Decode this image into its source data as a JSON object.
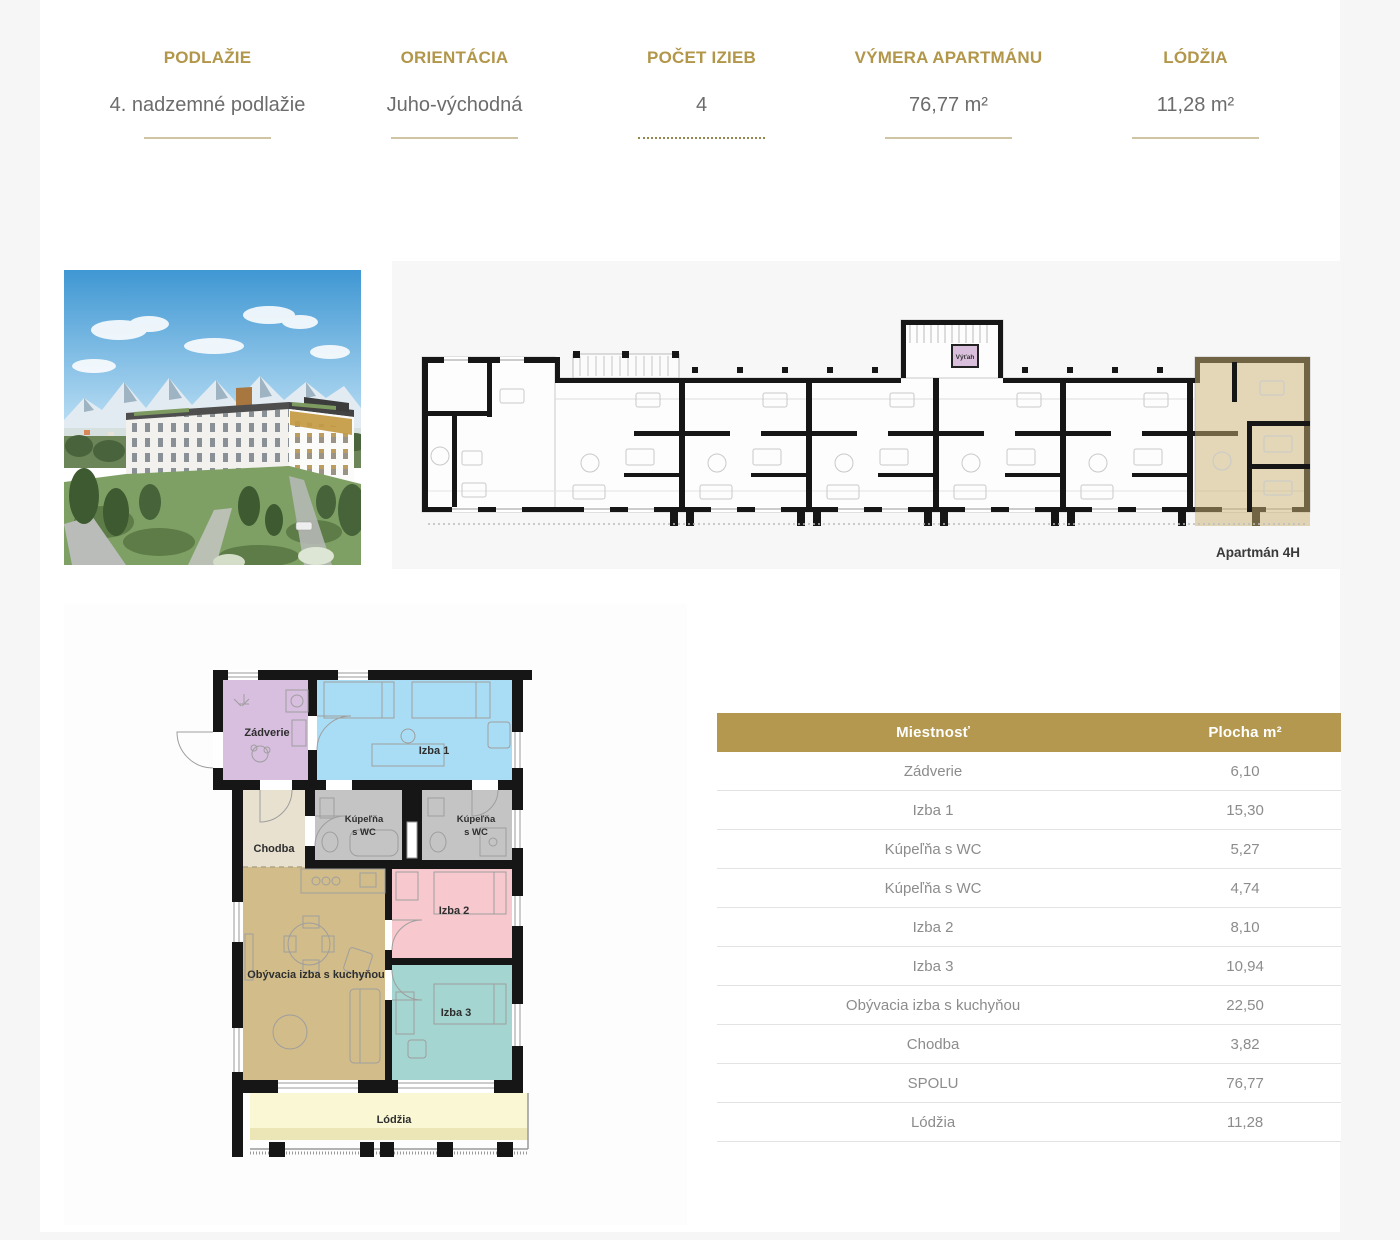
{
  "summary": {
    "items": [
      {
        "label": "PODLAŽIE",
        "value": "4. nadzemné podlažie"
      },
      {
        "label": "ORIENTÁCIA",
        "value": "Juho-východná"
      },
      {
        "label": "POČET IZIEB",
        "value": "4"
      },
      {
        "label": "VÝMERA APARTMÁNU",
        "value": "76,77 m²"
      },
      {
        "label": "LÓDŽIA",
        "value": "11,28 m²"
      }
    ]
  },
  "overview_plan": {
    "apartment_label": "Apartmán 4H",
    "elevator_label": "Výťah",
    "highlight_color": "#c9b173"
  },
  "detail_plan": {
    "rooms": {
      "zadverie": "Zádverie",
      "izba1": "Izba 1",
      "chodba": "Chodba",
      "kupelna_line1": "Kúpeľňa",
      "kupelna_line2": "s WC",
      "obyvacia": "Obývacia izba s kuchyňou",
      "izba2": "Izba 2",
      "izba3": "Izba 3",
      "lodzia": "Lódžia"
    },
    "room_colors": {
      "zadverie": "#d8bfdf",
      "izba1": "#a9ddf5",
      "chodba": "#e8e1d0",
      "kupelna": "#c4c4c4",
      "obyvacia": "#d2bd8a",
      "izba2": "#f7c9cf",
      "izba3": "#a5d5d0",
      "lodzia": "#faf7d4",
      "elevator": "#d9bfdb"
    },
    "accent_gold": "#b5984f"
  },
  "table": {
    "header": [
      "Miestnosť",
      "Plocha m²"
    ],
    "rows": [
      [
        "Zádverie",
        "6,10"
      ],
      [
        "Izba 1",
        "15,30"
      ],
      [
        "Kúpeľňa s WC",
        "5,27"
      ],
      [
        "Kúpeľňa s WC",
        "4,74"
      ],
      [
        "Izba 2",
        "8,10"
      ],
      [
        "Izba 3",
        "10,94"
      ],
      [
        "Obývacia izba s kuchyňou",
        "22,50"
      ],
      [
        "Chodba",
        "3,82"
      ],
      [
        "SPOLU",
        "76,77"
      ],
      [
        "Lódžia",
        "11,28"
      ]
    ]
  }
}
